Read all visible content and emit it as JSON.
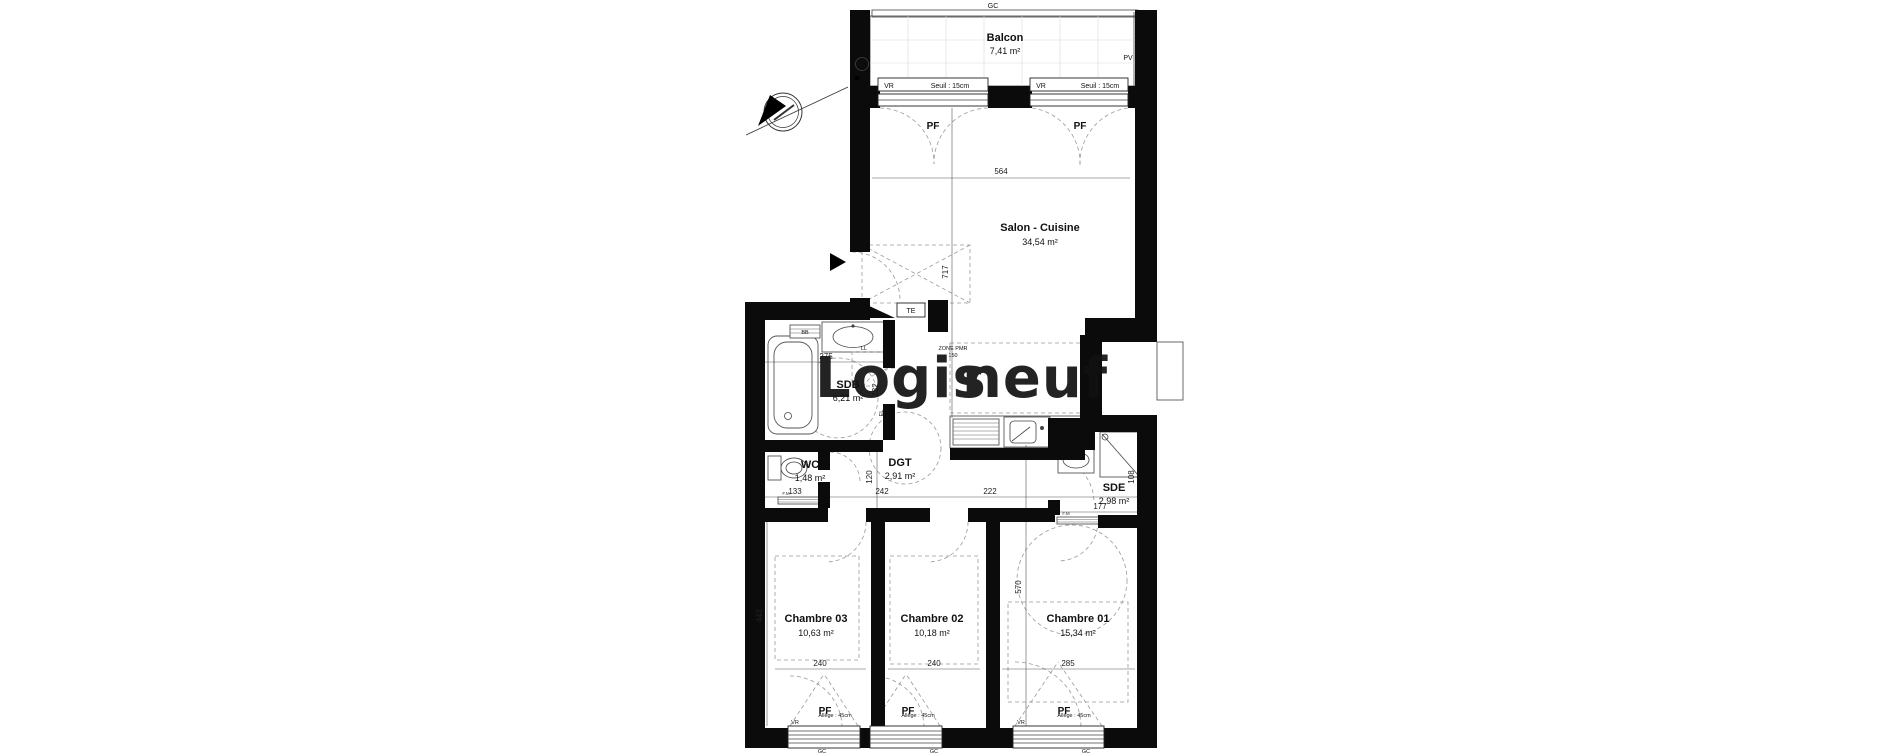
{
  "plan": {
    "rooms": {
      "balcon": {
        "name": "Balcon",
        "area": "7,41 m²"
      },
      "salon": {
        "name": "Salon - Cuisine",
        "area": "34,54 m²"
      },
      "sdb": {
        "name": "SDB",
        "area": "6,21 m²"
      },
      "wc": {
        "name": "WC",
        "area": "1,48 m²"
      },
      "dgt": {
        "name": "DGT",
        "area": "2,91 m²"
      },
      "sde": {
        "name": "SDE",
        "area": "2,98 m²"
      },
      "chambre3": {
        "name": "Chambre 03",
        "area": "10,63 m²"
      },
      "chambre2": {
        "name": "Chambre 02",
        "area": "10,18 m²"
      },
      "chambre1": {
        "name": "Chambre 01",
        "area": "15,34 m²"
      }
    },
    "dims": {
      "salon_width": "564",
      "entry_depth": "717",
      "sdb_width": "275",
      "sdb_height": "232",
      "dgt_height": "120",
      "hall_1": "133",
      "hall_2": "242",
      "hall_3": "222",
      "sde_width": "177",
      "sde_height": "108",
      "ch3_height": "443",
      "ch1_height": "570",
      "ch3_width": "240",
      "ch2_width": "240",
      "ch1_width": "285"
    },
    "labels": {
      "gc": "GC",
      "pv": "PV",
      "vr": "VR",
      "pf": "PF",
      "eb": "EB",
      "te": "TE",
      "bb": "BB",
      "ll": "LL",
      "el": "EL",
      "fm": "F.M",
      "seuil": "Seuil : 15cm",
      "allege": "Allège : 45cm",
      "zone_pmr_line1": "ZONE PMR",
      "zone_pmr_line2": "150"
    }
  },
  "watermark": {
    "part1": "Logis",
    "part2": "neuf",
    "color_gray": "#a3a3a1",
    "color_orange": "#f2a73e"
  }
}
